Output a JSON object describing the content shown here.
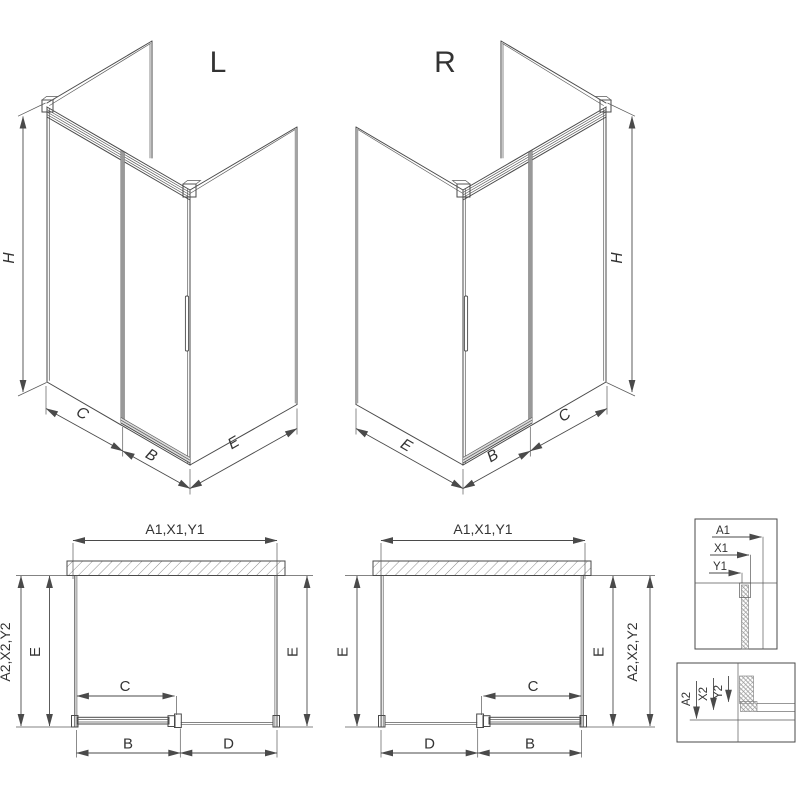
{
  "colors": {
    "line": "#4a4a4a",
    "hatch": "#8c8c8c",
    "glass_edge_strip": "#999999",
    "background": "#ffffff"
  },
  "iso_left": {
    "variant_label": "L",
    "dim_height": "H",
    "dim_fixed_panel": "C",
    "dim_door": "B",
    "dim_side_panel": "E"
  },
  "iso_right": {
    "variant_label": "R",
    "dim_height": "H",
    "dim_fixed_panel": "C",
    "dim_door": "B",
    "dim_side_panel": "E"
  },
  "plan_left": {
    "dim_width_top": "A1,X1,Y1",
    "dim_width_outer": "A2,X2,Y2",
    "dim_depth_left": "E",
    "dim_depth_right": "E",
    "dim_opening": "C",
    "dim_door": "B",
    "dim_fixed": "D"
  },
  "plan_right": {
    "dim_width_top": "A1,X1,Y1",
    "dim_width_outer": "A2,X2,Y2",
    "dim_depth_left": "E",
    "dim_depth_right": "E",
    "dim_opening": "C",
    "dim_door": "B",
    "dim_fixed": "D"
  },
  "detail_wall_profile": {
    "labels": [
      "A1",
      "X1",
      "Y1"
    ]
  },
  "detail_bottom_rail": {
    "labels": [
      "A2",
      "X2",
      "Y2"
    ]
  }
}
